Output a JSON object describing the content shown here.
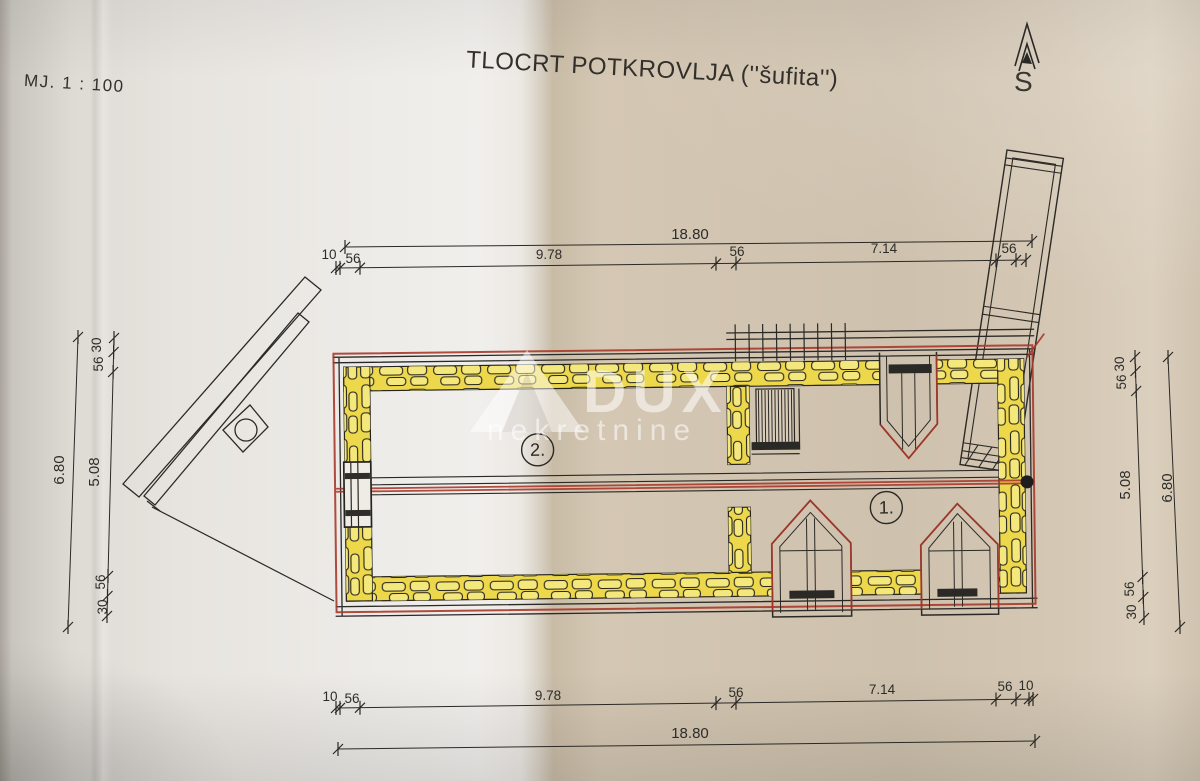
{
  "header": {
    "scale": "MJ. 1 : 100",
    "title": "TLOCRT POTKROVLJA (''šufita'')",
    "north": "S"
  },
  "rooms": [
    {
      "label": "2."
    },
    {
      "label": "1."
    }
  ],
  "dims": {
    "top": {
      "total": "18.80",
      "segs": [
        "10",
        "56",
        "9.78",
        "56",
        "7.14",
        "56"
      ]
    },
    "bottom": {
      "total": "18.80",
      "segs": [
        "10",
        "56",
        "9.78",
        "56",
        "7.14",
        "56",
        "10"
      ]
    },
    "left": {
      "total": "6.80",
      "segs": [
        "30",
        "56",
        "5.08",
        "56",
        "30"
      ]
    },
    "right": {
      "total": "6.80",
      "segs": [
        "30",
        "56",
        "5.08",
        "56",
        "30"
      ]
    }
  },
  "watermark": {
    "brand": "DUX",
    "sub": "nekretnine"
  },
  "colors": {
    "wall_highlight": "#edd74b",
    "stone_fill": "#f4e77b",
    "pen_red": "#a8382b",
    "ink": "#2b2926"
  }
}
